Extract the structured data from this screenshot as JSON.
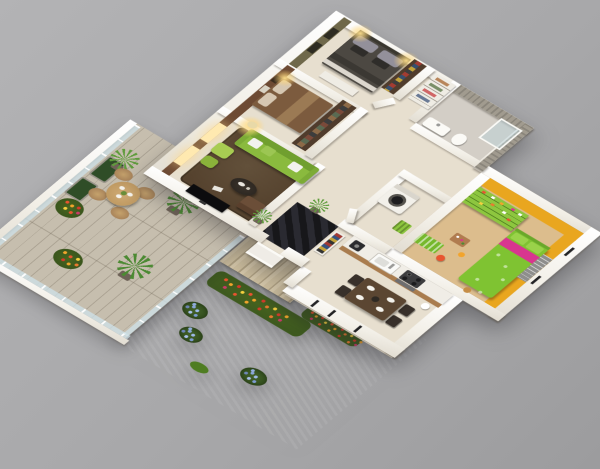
{
  "scene": {
    "description": "Isometric 3D cutaway floor plan render of a three-bedroom apartment with wooden terrace and lower garden, on a plain gray studio background",
    "view": "aerial isometric, walls cut away, no visible text or UI"
  },
  "palette": {
    "bg": "#a8a8aa",
    "bg-light": "#b3b3b5",
    "bg-dark": "#9c9c9e",
    "wall-white": "#f2efe7",
    "floor-cream": "#e7dfcf",
    "tile-gray": "#d3cec6",
    "accent-brown": "#6d4a33",
    "accent-olive": "#6f684a",
    "accent-orange": "#e9a61f",
    "accent-stone": "#a19b8f",
    "kids-floor": "#dcbd8d",
    "kids-green": "#7fc332",
    "kids-pink": "#d8368f",
    "shelf-green": "#8dc63f",
    "sofa-green": "#8aba3e",
    "pouf-green": "#a8cc52",
    "rug-brown": "#55422e",
    "rug-black": "#17171a",
    "bed-dark": "#4c4842",
    "bed-brown": "#7c5b3e",
    "wardrobe-wood": "#503c2c",
    "table-wood": "#5b4632",
    "counter-white": "#f0ede6",
    "counter-wood": "#a97c4e",
    "deck-wood": "#c6beae",
    "deck-line": "#9e9480",
    "glass-rail": "rgba(205,226,233,0.75)",
    "grass": "#7fcb2f",
    "grass-dark": "#6cb526",
    "stair-wood": "#cfc0a0",
    "palm-green": "#4c8a33",
    "hedge-green": "#2f4d27",
    "lamp-glow": "#ffd98a"
  },
  "rooms": [
    {
      "name": "Master bedroom",
      "features": [
        "charcoal double bed",
        "patterned gray pillows",
        "olive accent wall with windows",
        "warm wall lamps",
        "wardrobe with clothes",
        "white dresser"
      ]
    },
    {
      "name": "Second bedroom",
      "features": [
        "brown double bed",
        "beige pillows",
        "brown accent wall with framed pictures",
        "wardrobe",
        "bedside lamp glow"
      ]
    },
    {
      "name": "Bathroom",
      "features": [
        "gray stone accent wall",
        "glass shower",
        "white washbasin",
        "toilet"
      ]
    },
    {
      "name": "Hallway closet",
      "features": [
        "white shelving with linens"
      ]
    },
    {
      "name": "Living room",
      "features": [
        "lime green three-seat sofa",
        "white and green cushions",
        "dark brown rug",
        "round coffee table with tray",
        "wall-mounted flat TV",
        "glowing floor lamp",
        "two green poufs",
        "brown armchair",
        "potted plant",
        "brown window wall with two lit windows"
      ]
    },
    {
      "name": "Entry hall",
      "features": [
        "black diamond-checkered rug",
        "shelf with clothes and shoes",
        "potted plant",
        "front door porch"
      ]
    },
    {
      "name": "Laundry room",
      "features": [
        "washing machine with round door",
        "green laundry basket"
      ]
    },
    {
      "name": "Kids bedroom",
      "features": [
        "orange walls",
        "sand-colored floor",
        "green single bed with magenta blanket band",
        "green pillows",
        "tall lime shelving unit with toys",
        "green toy box",
        "scattered toys",
        "gray window blinds"
      ]
    },
    {
      "name": "Kitchen",
      "features": [
        "white counter with wood front",
        "coffee maker",
        "sink with faucet",
        "dark cooktop with four burners",
        "oven",
        "white canister"
      ]
    },
    {
      "name": "Dining area",
      "features": [
        "dark wood rectangular table",
        "four dark chairs",
        "white plates",
        "dark centerpiece"
      ]
    }
  ],
  "outdoor": [
    {
      "name": "Terrace deck",
      "features": [
        "light wooden planks",
        "glass railing with posts",
        "round wicker table",
        "four wicker chairs",
        "three potted palms",
        "two dark hedge planters",
        "red and orange flower bushes"
      ]
    },
    {
      "name": "Garden",
      "features": [
        "bright green lawn one level below",
        "wooden stairs down from deck",
        "long flower bed with red, orange and yellow flowers",
        "marigold bed along house wall",
        "three blue hydrangea bushes",
        "white retaining wall"
      ]
    }
  ]
}
